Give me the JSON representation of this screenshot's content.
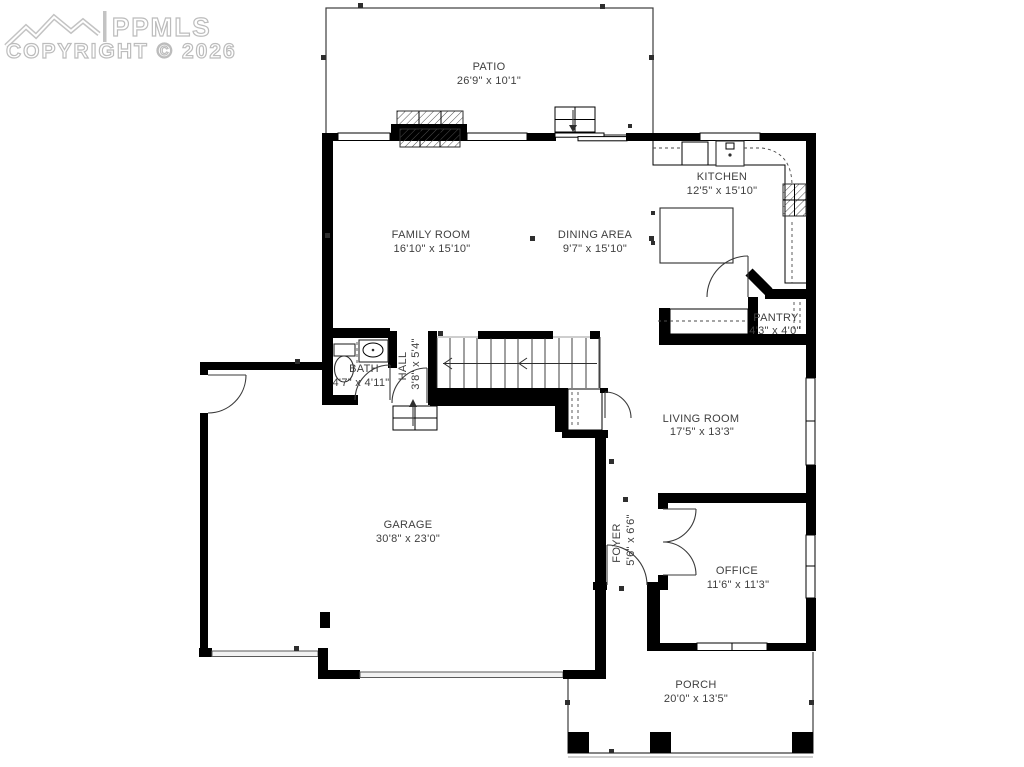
{
  "watermark": {
    "brand": "PPMLS",
    "copyright": "COPYRIGHT © 2026",
    "logo_icon": "mountain-peaks-icon"
  },
  "rooms": {
    "patio": {
      "name": "PATIO",
      "dims": "26'9\" x 10'1\""
    },
    "family_room": {
      "name": "FAMILY ROOM",
      "dims": "16'10\" x 15'10\""
    },
    "dining_area": {
      "name": "DINING AREA",
      "dims": "9'7\" x 15'10\""
    },
    "kitchen": {
      "name": "KITCHEN",
      "dims": "12'5\" x 15'10\""
    },
    "pantry": {
      "name": "PANTRY",
      "dims": "4'3\" x 4'0\""
    },
    "bath": {
      "name": "BATH",
      "dims": "4'7\" x 4'11\""
    },
    "hall": {
      "name": "HALL",
      "dims": "3'8\" x 5'4\""
    },
    "living_room": {
      "name": "LIVING ROOM",
      "dims": "17'5\" x 13'3\""
    },
    "garage": {
      "name": "GARAGE",
      "dims": "30'8\" x 23'0\""
    },
    "foyer": {
      "name": "FOYER",
      "dims": "5'6\" x 6'6\""
    },
    "office": {
      "name": "OFFICE",
      "dims": "11'6\" x 11'3\""
    },
    "porch": {
      "name": "PORCH",
      "dims": "20'0\" x 13'5\""
    }
  },
  "colors": {
    "wall": "#000000",
    "outline": "#3c3c3c",
    "text": "#3f3f3f",
    "watermark": "#bcbcbc",
    "background": "#ffffff"
  }
}
